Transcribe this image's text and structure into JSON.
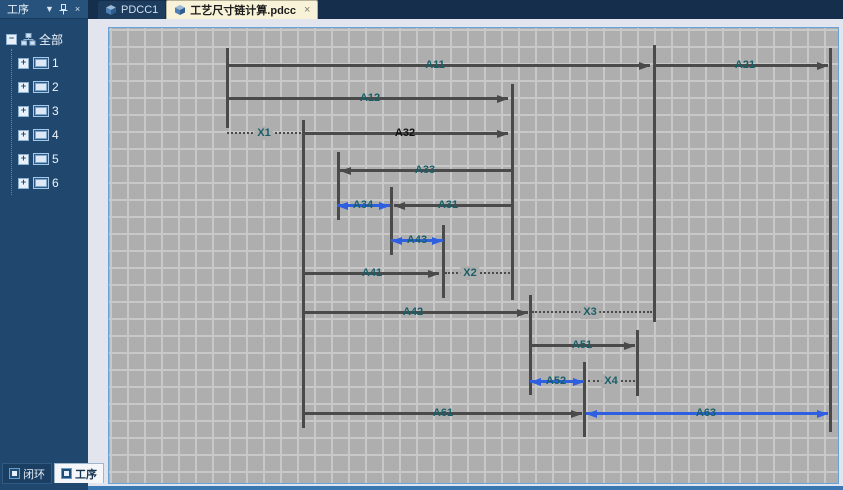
{
  "sidebar": {
    "title": "工序",
    "header_icons": [
      {
        "name": "chevron-down-icon",
        "glyph": "▼"
      },
      {
        "name": "pin-icon",
        "glyph": "pin"
      },
      {
        "name": "close-icon",
        "glyph": "×"
      }
    ],
    "tree": {
      "root_label": "全部",
      "root_expander": "−",
      "item_expander": "+",
      "items": [
        {
          "label": "1"
        },
        {
          "label": "2"
        },
        {
          "label": "3"
        },
        {
          "label": "4"
        },
        {
          "label": "5"
        },
        {
          "label": "6"
        }
      ]
    },
    "bottom_tabs": [
      {
        "label": "闭环",
        "active": false
      },
      {
        "label": "工序",
        "active": true
      }
    ]
  },
  "tabbar": {
    "tabs": [
      {
        "label": "PDCC1",
        "active": false,
        "closable": false
      },
      {
        "label": "工艺尺寸链计算.pdcc",
        "active": true,
        "closable": true,
        "close_glyph": "×"
      }
    ]
  },
  "diagram": {
    "type": "process-dimension-chain",
    "grid_size": 17,
    "colors": {
      "canvas_bg": "#aeaeae",
      "grid_line": "#c8c8c8",
      "line": "#4a4a4a",
      "highlight_blue": "#2e5fe0",
      "label": "#175f68",
      "label_emphasis": "#101010",
      "canvas_border": "#69a2d8"
    },
    "verticals": [
      {
        "x": 227,
        "y1": 48,
        "y2": 128
      },
      {
        "x": 303,
        "y1": 120,
        "y2": 428
      },
      {
        "x": 338,
        "y1": 152,
        "y2": 220
      },
      {
        "x": 391,
        "y1": 187,
        "y2": 255
      },
      {
        "x": 443,
        "y1": 225,
        "y2": 298
      },
      {
        "x": 512,
        "y1": 84,
        "y2": 300
      },
      {
        "x": 530,
        "y1": 295,
        "y2": 395
      },
      {
        "x": 584,
        "y1": 362,
        "y2": 437
      },
      {
        "x": 637,
        "y1": 330,
        "y2": 396
      },
      {
        "x": 654,
        "y1": 45,
        "y2": 322
      },
      {
        "x": 830,
        "y1": 48,
        "y2": 432
      }
    ],
    "dimensions": [
      {
        "label": "A11",
        "y": 65,
        "x1": 227,
        "x2": 650,
        "type": "solid",
        "arrow": "right",
        "lx": 435
      },
      {
        "label": "A21",
        "y": 65,
        "x1": 654,
        "x2": 828,
        "type": "solid",
        "arrow": "right",
        "lx": 745
      },
      {
        "label": "A12",
        "y": 98,
        "x1": 227,
        "x2": 508,
        "type": "solid",
        "arrow": "right",
        "lx": 370
      },
      {
        "label": "X1",
        "y": 133,
        "x1": 227,
        "x2": 301,
        "type": "dotted",
        "arrow": "none",
        "lx": 264
      },
      {
        "label": "A32",
        "y": 133,
        "x1": 303,
        "x2": 508,
        "type": "solid",
        "arrow": "right",
        "lx": 405,
        "emphasis": true
      },
      {
        "label": "A33",
        "y": 170,
        "x1": 340,
        "x2": 512,
        "type": "solid",
        "arrow": "left",
        "lx": 425
      },
      {
        "label": "A34",
        "y": 205,
        "x1": 337,
        "x2": 390,
        "type": "blue",
        "arrow": "both",
        "lx": 363
      },
      {
        "label": "A31",
        "y": 205,
        "x1": 394,
        "x2": 512,
        "type": "solid",
        "arrow": "left",
        "lx": 448
      },
      {
        "label": "A43",
        "y": 240,
        "x1": 391,
        "x2": 443,
        "type": "blue",
        "arrow": "both",
        "lx": 417
      },
      {
        "label": "A41",
        "y": 273,
        "x1": 303,
        "x2": 439,
        "type": "solid",
        "arrow": "right",
        "lx": 372
      },
      {
        "label": "X2",
        "y": 273,
        "x1": 445,
        "x2": 510,
        "type": "dotted",
        "arrow": "none",
        "lx": 470
      },
      {
        "label": "A42",
        "y": 312,
        "x1": 303,
        "x2": 528,
        "type": "solid",
        "arrow": "right",
        "lx": 413
      },
      {
        "label": "X3",
        "y": 312,
        "x1": 532,
        "x2": 652,
        "type": "dotted",
        "arrow": "none",
        "lx": 590
      },
      {
        "label": "A51",
        "y": 345,
        "x1": 530,
        "x2": 635,
        "type": "solid",
        "arrow": "right",
        "lx": 582
      },
      {
        "label": "A52",
        "y": 381,
        "x1": 530,
        "x2": 584,
        "type": "blue",
        "arrow": "both",
        "lx": 556
      },
      {
        "label": "X4",
        "y": 381,
        "x1": 588,
        "x2": 635,
        "type": "dotted",
        "arrow": "none",
        "lx": 611
      },
      {
        "label": "A61",
        "y": 413,
        "x1": 303,
        "x2": 582,
        "type": "solid",
        "arrow": "right",
        "lx": 443
      },
      {
        "label": "A63",
        "y": 413,
        "x1": 586,
        "x2": 828,
        "type": "blue",
        "arrow": "both",
        "lx": 706
      }
    ]
  }
}
